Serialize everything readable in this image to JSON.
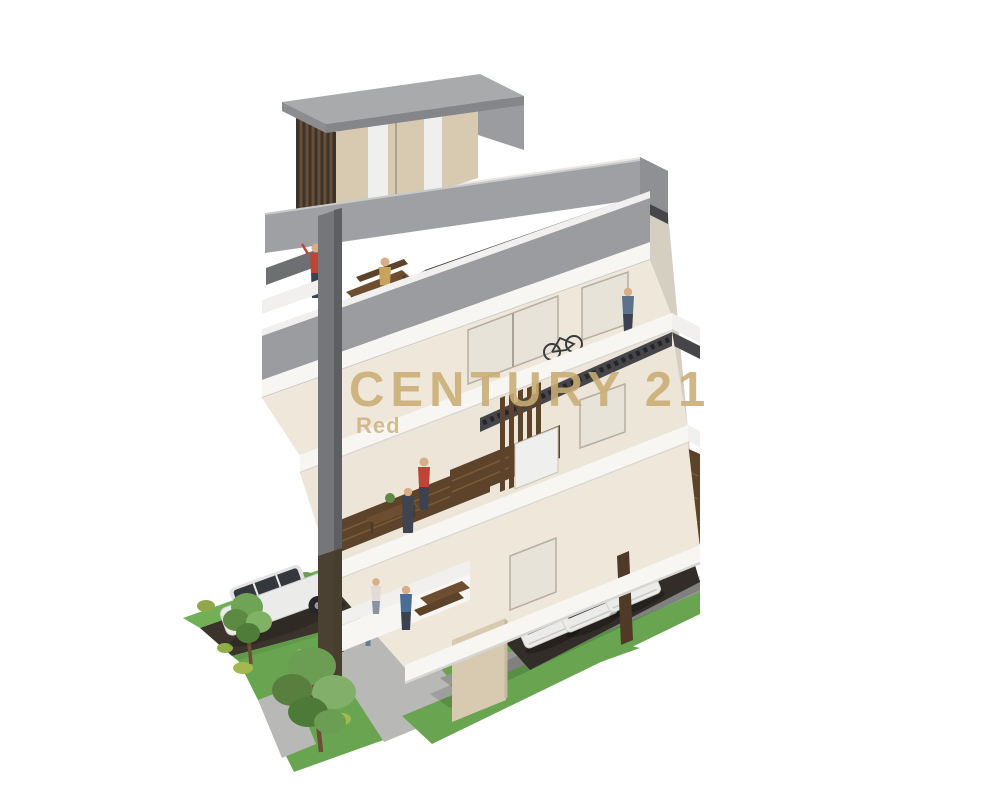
{
  "image": {
    "description": "3D architectural cutaway rendering of a modern multi-storey apartment building on a white background, viewed from above at a corner angle. The section view exposes balconies and interiors with small human figures, wooden tables, a bicycle, wood-slat cladding, a roof terrace and a gray penthouse. At street level there is a lawn with two trees, gray walkways, a dark driveway with a white SUV, and three white cars parked under the building. A gold brand watermark overlays the center.",
    "width": 1000,
    "height": 801,
    "background": "#ffffff"
  },
  "watermark": {
    "brand": "CENTURY 21",
    "subtitle": "Red",
    "color": "#c9ad74"
  },
  "palette": {
    "watermark_gold": "#c9ad74",
    "roof_gray": "#a9aaac",
    "parapet_gray": "#9b9c9f",
    "wall_cream": "#d8cab0",
    "slab_white": "#f7f6f3",
    "wood_brown": "#5d4329",
    "louver_dark": "#46464a",
    "grass_green": "#69a551",
    "driveway_dark": "#3b342d",
    "walkway_gray": "#b8b8b6"
  },
  "scene": {
    "visible_floors": 5,
    "people_figures": 9,
    "cars_parked_under_building": 3,
    "suv_on_driveway": 1,
    "trees": 2
  }
}
